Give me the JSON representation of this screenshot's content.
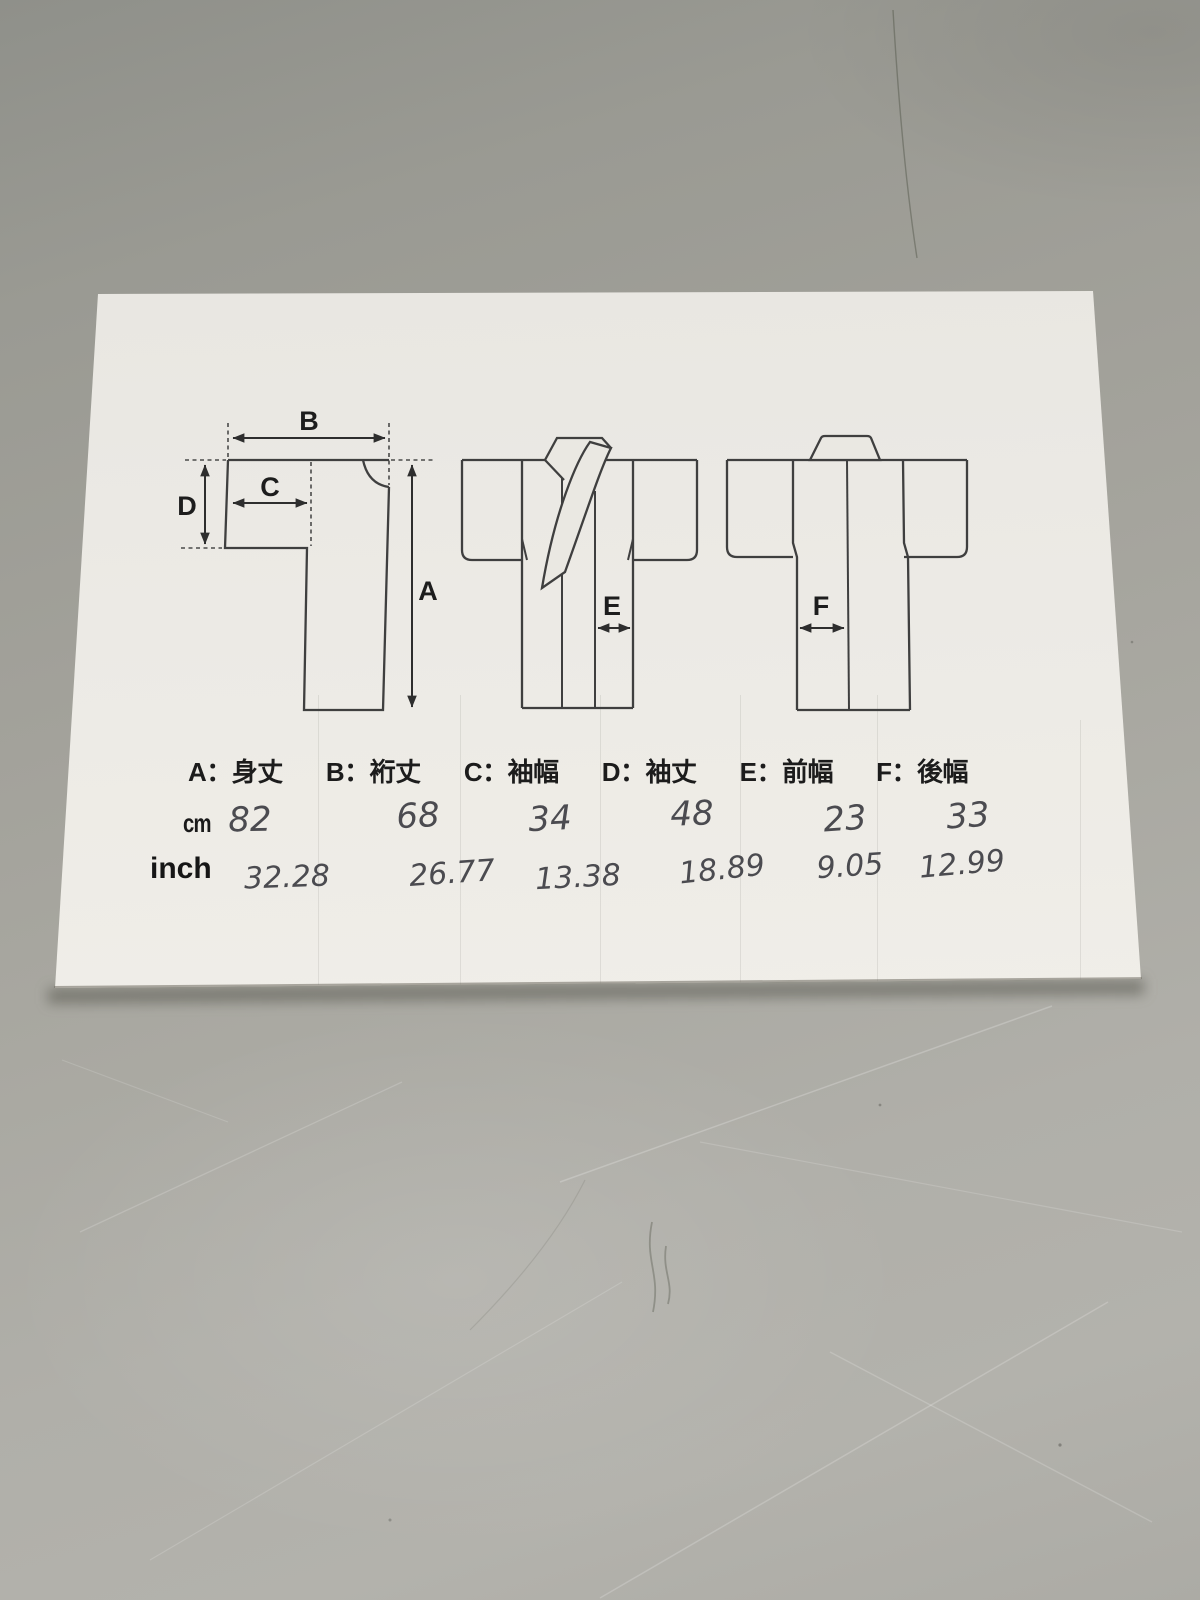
{
  "colors": {
    "surface_gray": "#a2a19a",
    "paper_white": "#efede7",
    "print_ink": "#3f3f3f",
    "pen_ink": "#4b4b50"
  },
  "legend": {
    "items": [
      "A：身丈",
      "B：裄丈",
      "C：袖幅",
      "D：袖丈",
      "E：前幅",
      "F：後幅"
    ]
  },
  "measurements": {
    "cm": {
      "label": "cm",
      "values": [
        "82",
        "68",
        "34",
        "48",
        "23",
        "33"
      ]
    },
    "inch": {
      "label": "inch",
      "values": [
        "32.28",
        "26.77",
        "13.38",
        "18.89",
        "9.05",
        "12.99"
      ]
    }
  },
  "diagram_labels": {
    "A": "A",
    "B": "B",
    "C": "C",
    "D": "D",
    "E": "E",
    "F": "F"
  }
}
